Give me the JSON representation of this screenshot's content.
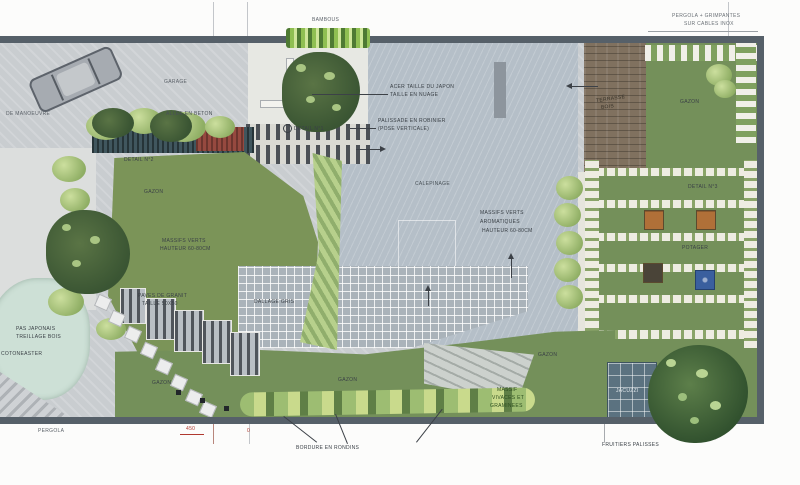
{
  "colors": {
    "plan_border": "#566069",
    "paving_blue_gray": "#b5bfc8",
    "lawn_green": "#74905a",
    "deck_brown": "#80715f",
    "hedge_dark": "#40565e",
    "pond": "#cde0d6",
    "accent_red": "#b0392f"
  },
  "labels": {
    "pergola_top_1": "PERGOLA + GRIMPANTES",
    "pergola_top_2": "SUR CABLES INOX",
    "bambous": "BAMBOUS",
    "garage": "GARAGE",
    "de_manoeuvre": "DE MANOEUVRE",
    "allee_beton": "ALLEE EN BETON",
    "acer_1": "ACER TAILLE DU JAPON",
    "acer_2": "TAILLE EN NUAGE",
    "palissade_1": "PALISSADE EN ROBINIER",
    "palissade_2": "(POSE VERTICALE)",
    "detail_1": "DETAIL N°1",
    "detail_2": "DETAIL N°2",
    "detail_3": "DETAIL N°3",
    "gazon": "GAZON",
    "calepinage": "CALEPINAGE",
    "terrasse_1": "TERRASSE",
    "terrasse_2": "BOIS",
    "massifs_left_1": "MASSIFS VERTS",
    "massifs_left_2": "HAUTEUR 60-80CM",
    "paves_1": "PAVES DE GRANIT",
    "paves_2": "TAILLE 50X50",
    "dallage_gris": "DALLAGE GRIS",
    "arom_1": "MASSIFS VERTS",
    "arom_2": "AROMATIQUES",
    "arom_3": "HAUTEUR 60-80CM",
    "pas_japonais_1": "PAS JAPONAIS",
    "pas_japonais_2": "TREILLAGE BOIS",
    "cotoneaster": "COTONEASTER",
    "potager": "POTAGER",
    "vivaces_1": "MASSIF",
    "vivaces_2": "VIVACES ET",
    "vivaces_3": "GRAMINEES",
    "jacuzzi": "JACUZZI",
    "bordure_rondins": "BORDURE EN RONDINS",
    "fruitiers": "FRUITIERS PALISSES",
    "pergola_bottom": "PERGOLA",
    "dim_450": "450",
    "dim_0": "0"
  }
}
